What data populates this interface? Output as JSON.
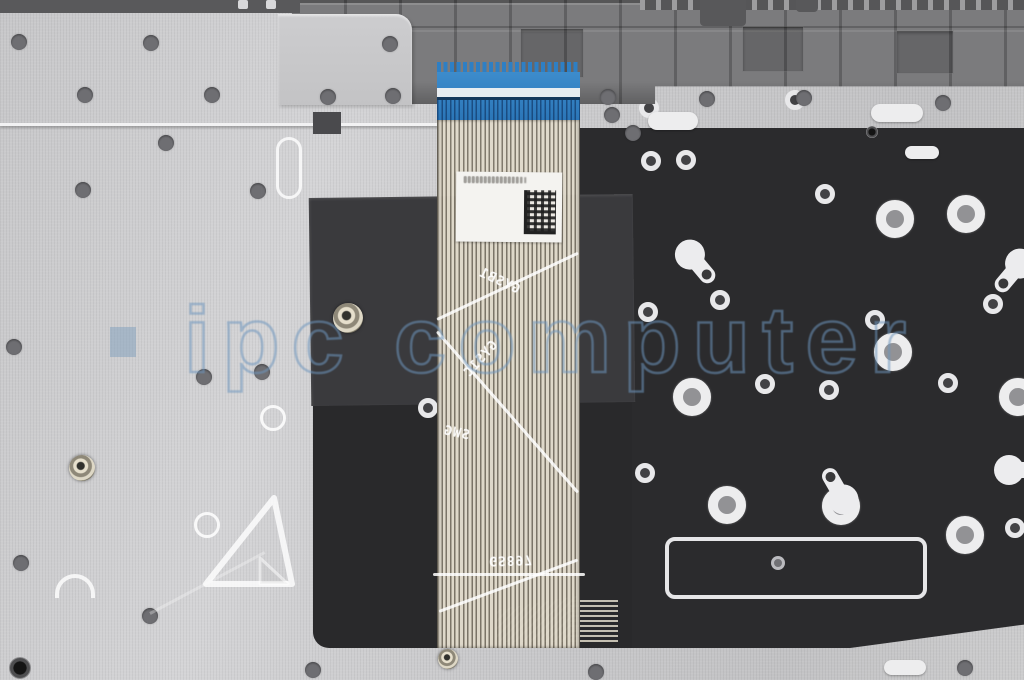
{
  "scene": {
    "subject": "Rear view photo of a laptop palmrest / keyboard assembly spare part with attached keyboard ribbon flex cable and blue connector"
  },
  "watermark": {
    "text": "ipc computer"
  },
  "cable": {
    "connector_color": "#2e7fc4",
    "prints": [
      {
        "text": "GYSB1",
        "x": 40,
        "y": 212,
        "rot": -25,
        "mirror": "x"
      },
      {
        "text": "GYS1C",
        "x": 22,
        "y": 290,
        "rot": 48,
        "mirror": "x"
      },
      {
        "text": "SWG",
        "x": 6,
        "y": 364,
        "rot": -12,
        "mirror": "x"
      },
      {
        "text": "GS897",
        "x": 52,
        "y": 490,
        "rot": 2,
        "mirror": "y"
      }
    ],
    "creases": [
      {
        "x": 0,
        "y": 256,
        "len": 156,
        "rot": -25.2
      },
      {
        "x": 0,
        "y": 268,
        "len": 214,
        "rot": 48.8
      },
      {
        "x": -4,
        "y": 511,
        "len": 152,
        "rot": 0
      },
      {
        "x": 2,
        "y": 548,
        "len": 148,
        "rot": -20.4
      }
    ],
    "label": {
      "datamatrix": true,
      "text_illegible": true,
      "line_widths": [
        58,
        62,
        55,
        48
      ]
    }
  },
  "plate": {
    "dots": [
      [
        19,
        42
      ],
      [
        151,
        43
      ],
      [
        390,
        44
      ],
      [
        85,
        95
      ],
      [
        212,
        95
      ],
      [
        328,
        97
      ],
      [
        393,
        96
      ],
      [
        166,
        143
      ],
      [
        83,
        190
      ],
      [
        258,
        191
      ],
      [
        14,
        347
      ],
      [
        262,
        372
      ],
      [
        204,
        377
      ],
      [
        21,
        563
      ],
      [
        150,
        616
      ],
      [
        313,
        670
      ],
      [
        596,
        672
      ],
      [
        965,
        668
      ],
      [
        608,
        97
      ],
      [
        707,
        99
      ],
      [
        804,
        98
      ],
      [
        943,
        103
      ],
      [
        612,
        115
      ],
      [
        633,
        133
      ]
    ],
    "eyelets": [
      {
        "x": 348,
        "y": 318,
        "d": 30,
        "style": "gold"
      },
      {
        "x": 82,
        "y": 468,
        "d": 26,
        "style": "gold"
      },
      {
        "x": 448,
        "y": 659,
        "d": 20,
        "style": "gold"
      },
      {
        "x": 20,
        "y": 668,
        "d": 22,
        "style": "dark"
      },
      {
        "x": 872,
        "y": 132,
        "d": 12,
        "style": "dark"
      }
    ],
    "pill_outlines": [
      {
        "x": 289,
        "y": 168,
        "w": 26,
        "h": 62
      }
    ],
    "ring_outlines": [
      [
        273,
        418
      ],
      [
        207,
        525
      ]
    ],
    "solid_pills": [
      [
        673,
        121,
        50,
        18
      ],
      [
        897,
        113,
        52,
        18
      ],
      [
        922,
        152,
        34,
        13
      ],
      [
        905,
        667,
        42,
        15
      ]
    ],
    "half_ovals": [
      {
        "x": 75,
        "y": 586,
        "w": 40,
        "h": 24
      }
    ],
    "studs": [
      [
        238,
        0,
        10,
        9
      ],
      [
        266,
        0,
        10,
        9
      ]
    ]
  },
  "membrane": {
    "rings": [
      [
        895,
        219
      ],
      [
        966,
        214
      ],
      [
        893,
        352
      ],
      [
        692,
        397
      ],
      [
        727,
        505
      ],
      [
        841,
        506
      ],
      [
        965,
        535
      ],
      [
        1018,
        397
      ]
    ],
    "dots": [
      [
        649,
        108
      ],
      [
        795,
        100
      ],
      [
        651,
        161
      ],
      [
        686,
        160
      ],
      [
        825,
        194
      ],
      [
        720,
        300
      ],
      [
        993,
        304
      ],
      [
        648,
        312
      ],
      [
        875,
        320
      ],
      [
        765,
        384
      ],
      [
        829,
        390
      ],
      [
        948,
        383
      ],
      [
        645,
        473
      ],
      [
        1015,
        528
      ],
      [
        428,
        408
      ]
    ],
    "teardrops": [
      {
        "x": 697,
        "y": 263,
        "rot": -40
      },
      {
        "x": 1013,
        "y": 272,
        "rot": 40
      },
      {
        "x": 838,
        "y": 490,
        "rot": 150
      },
      {
        "x": 1020,
        "y": 470,
        "rot": -90
      }
    ],
    "stabilizer": {
      "x": 665,
      "y": 537,
      "w": 262,
      "h": 62,
      "dot": {
        "x": 778,
        "y": 563
      }
    }
  },
  "chassis": {
    "compartments": [
      [
        520,
        28,
        64,
        50
      ],
      [
        742,
        26,
        62,
        46
      ],
      [
        896,
        30,
        58,
        44
      ]
    ],
    "top_tabs": [
      [
        700,
        0,
        46,
        26
      ],
      [
        796,
        0,
        22,
        12
      ]
    ]
  }
}
